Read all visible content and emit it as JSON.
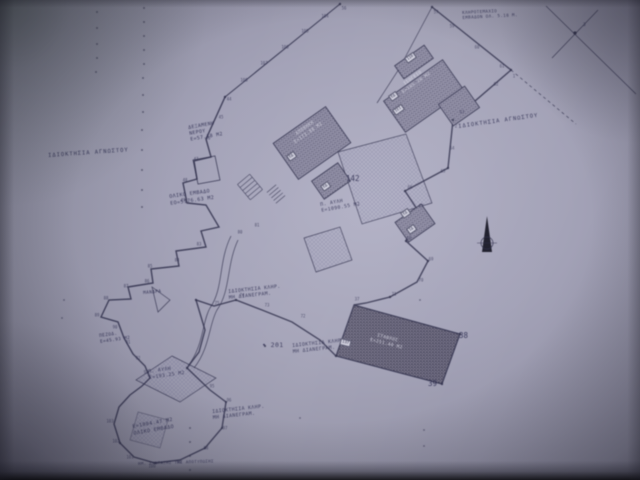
{
  "colors": {
    "paper": "#a3a2b7",
    "ink": "#2e2e4c",
    "building_hatch": "#8f8da6",
    "building_dark": "#6b687f",
    "light_text": "#e0e0ee"
  },
  "annotations": {
    "note_top": {
      "line1": "ΚΛΗΡΟΤΕΜΑΧΙΟ",
      "line2": "ΕΜΒΑΔΟΝ ΟΛ. 5.18 Μ."
    },
    "triangulation_label": "3",
    "owner_left": "ΙΔΙΟΚΤΗΣΙΑ ΑΓΝΩΣΤΟΥ",
    "owner_right": "ΙΔΙΟΚΤΗΣΙΑ ΑΓΝΩΣΤΟΥ",
    "tank": {
      "line1": "ΔΕΞΑΜΕΝΗ",
      "line2": "ΝΕΡΟΥ",
      "line3": "Ε=57.18 Μ2"
    },
    "total_area": {
      "line1": "ΟΛΙΚΟ ΕΜΒΑΔΟ",
      "line2": "ΕΟ=5176.63 Μ2"
    },
    "claim_note": {
      "line1": "ΙΔΙΟΚΤΗΣΙΑ ΚΛΗΡ.",
      "line2": "ΜΗ ΔΙΑΝΕΓΡΑΜ."
    },
    "mandra": "ΜΑΝΔΡΑ",
    "pezod": {
      "line1": "ΠΕΖΟΔ.",
      "line2": "Ε=45.93 Μ2"
    },
    "yard_mid": {
      "line1": "Π. ΑΥΛΗ",
      "line2": "Ε=1090.55 Μ2"
    },
    "yard_low": {
      "line1": "Π. ΑΥΛΗ",
      "line2": "Ε=193.25 Μ2"
    },
    "boot_total": {
      "line1": "Ε=1004.47 Μ2",
      "line2": "ΟΛΙΚΟ ΕΜΒΑΔΟ"
    },
    "footer": "ΗΜ. ΣΥΝΤΑΞΗΣ ΤΗΣ ΑΠΟΤΥΠΩΣΗΣ",
    "area_142": "142",
    "point_201": "201",
    "point_38": "38",
    "point_39": "39"
  },
  "buildings": {
    "small_top": {
      "tag": "110"
    },
    "storehouse_top": {
      "tag": "ΕΔ",
      "tag2": "ΙΕΙ",
      "line1": "ΙΣΟΓΕΙΟ",
      "line2": "Ε=105.20 Μ2"
    },
    "storehouse_mid": {
      "tag": "ΕΔ",
      "line1": "ΑΠΟΘΗΚΗ",
      "line2": "Ε=173.80 Μ2"
    },
    "small_mid": {
      "tag": "ΕΔ"
    },
    "small_right": {
      "tag": "ΕΔ",
      "tag2": "ΙΔ"
    },
    "stable": {
      "tag": "137",
      "line1": "ΣΤΑΒΛΟΣ",
      "line2": "Ε=251.40 Μ2"
    }
  },
  "points": [
    {
      "x": 325,
      "y": 16,
      "t": "104"
    },
    {
      "x": 305,
      "y": 31,
      "t": "105"
    },
    {
      "x": 285,
      "y": 47,
      "t": "106"
    },
    {
      "x": 264,
      "y": 63,
      "t": "107"
    },
    {
      "x": 244,
      "y": 80,
      "t": "108"
    },
    {
      "x": 344,
      "y": 8,
      "t": "56"
    },
    {
      "x": 436,
      "y": 12,
      "t": "57"
    },
    {
      "x": 452,
      "y": 26,
      "t": "59"
    },
    {
      "x": 477,
      "y": 47,
      "t": "60"
    },
    {
      "x": 502,
      "y": 66,
      "t": "61"
    },
    {
      "x": 514,
      "y": 76,
      "t": "1"
    },
    {
      "x": 496,
      "y": 84,
      "t": "62"
    },
    {
      "x": 456,
      "y": 126,
      "t": "2"
    },
    {
      "x": 462,
      "y": 112,
      "t": "63"
    },
    {
      "x": 452,
      "y": 148,
      "t": "64"
    },
    {
      "x": 443,
      "y": 171,
      "t": "65"
    },
    {
      "x": 410,
      "y": 187,
      "t": "66"
    },
    {
      "x": 421,
      "y": 206,
      "t": "67"
    },
    {
      "x": 409,
      "y": 238,
      "t": "68"
    },
    {
      "x": 431,
      "y": 259,
      "t": "69"
    },
    {
      "x": 421,
      "y": 280,
      "t": "70"
    },
    {
      "x": 394,
      "y": 294,
      "t": "71"
    },
    {
      "x": 357,
      "y": 299,
      "t": "37"
    },
    {
      "x": 303,
      "y": 316,
      "t": "72"
    },
    {
      "x": 267,
      "y": 305,
      "t": "73"
    },
    {
      "x": 242,
      "y": 295,
      "t": "74"
    },
    {
      "x": 217,
      "y": 303,
      "t": "75"
    },
    {
      "x": 240,
      "y": 232,
      "t": "80"
    },
    {
      "x": 257,
      "y": 225,
      "t": "81"
    },
    {
      "x": 199,
      "y": 244,
      "t": "83"
    },
    {
      "x": 177,
      "y": 260,
      "t": "84"
    },
    {
      "x": 150,
      "y": 266,
      "t": "85"
    },
    {
      "x": 147,
      "y": 281,
      "t": "86"
    },
    {
      "x": 126,
      "y": 286,
      "t": "87"
    },
    {
      "x": 106,
      "y": 298,
      "t": "88"
    },
    {
      "x": 97,
      "y": 315,
      "t": "89"
    },
    {
      "x": 115,
      "y": 327,
      "t": "90"
    },
    {
      "x": 128,
      "y": 342,
      "t": "91"
    },
    {
      "x": 138,
      "y": 358,
      "t": "92"
    },
    {
      "x": 146,
      "y": 372,
      "t": "93"
    },
    {
      "x": 212,
      "y": 386,
      "t": "95"
    },
    {
      "x": 229,
      "y": 400,
      "t": "96"
    },
    {
      "x": 225,
      "y": 428,
      "t": "97"
    },
    {
      "x": 206,
      "y": 448,
      "t": "98"
    },
    {
      "x": 179,
      "y": 462,
      "t": "99"
    },
    {
      "x": 152,
      "y": 466,
      "t": "100"
    },
    {
      "x": 130,
      "y": 457,
      "t": "101"
    },
    {
      "x": 116,
      "y": 441,
      "t": "102"
    },
    {
      "x": 110,
      "y": 421,
      "t": "103"
    },
    {
      "x": 183,
      "y": 200,
      "t": "49"
    },
    {
      "x": 185,
      "y": 180,
      "t": "48"
    },
    {
      "x": 196,
      "y": 159,
      "t": "47"
    },
    {
      "x": 208,
      "y": 138,
      "t": "46"
    },
    {
      "x": 221,
      "y": 117,
      "t": "45"
    },
    {
      "x": 229,
      "y": 99,
      "t": "44"
    }
  ]
}
